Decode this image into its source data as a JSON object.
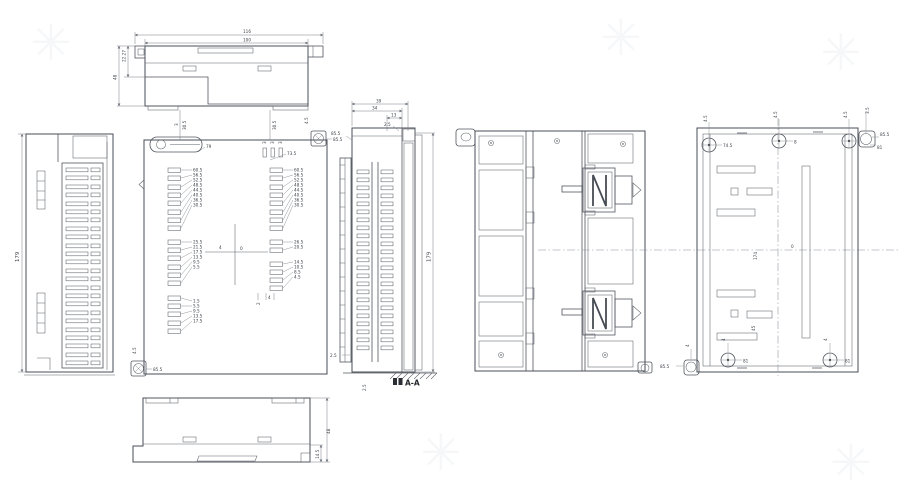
{
  "watermark": {
    "glyph": "✳"
  },
  "dims": {
    "top_view": {
      "outer_width": "116",
      "inner_width": "100",
      "step_depth": "22.27",
      "depth": "48"
    },
    "side_view": {
      "height": "179"
    },
    "front_view": {
      "t3a": "3",
      "t305a": "30.5",
      "din": "79",
      "t305b": "30.5",
      "t3b": "3",
      "t3c": "3",
      "t3d": "3",
      "slots3": "73.5",
      "pad_tr": "85.5",
      "pad_tr_v": "4.5",
      "ladder_left": [
        "60.5",
        "56.5",
        "52.5",
        "48.5",
        "44.5",
        "40.5",
        "36.5",
        "30.5",
        "25.5",
        "21.5",
        "17.5",
        "13.5",
        "9.5",
        "5.5",
        "1.5",
        "5.5",
        "9.5",
        "13.5",
        "17.5"
      ],
      "ladder_right": [
        "60.5",
        "56.5",
        "52.5",
        "48.5",
        "44.5",
        "40.5",
        "36.5",
        "30.5",
        "26.5",
        "20.5",
        "14.5",
        "10.5",
        "8.5",
        "4.5"
      ],
      "zero": "0",
      "tick4": "4",
      "b2": "2",
      "b4": "4",
      "pad_bl": "85.5",
      "pad_bl_v": "4.5"
    },
    "section_view": {
      "w39": "39",
      "w34": "34",
      "w13": "13",
      "t25": "2.5",
      "pad": "85.5",
      "height": "179",
      "b25a": "2.5",
      "b25b": "2.5",
      "label": "A-A"
    },
    "rear_view": {
      "hole_left": "74.5",
      "hole_mid": "8",
      "v1": "4.5",
      "v2": "4.5",
      "v3": "4.5",
      "v4": "3.5",
      "pad_tr_a": "85.5",
      "pad_tr_b": "81",
      "d174": "174",
      "zero": "0",
      "d45": "45",
      "pad_bl": "85.5",
      "pad_bl_v": "4",
      "bh1": "81",
      "bh2": "81",
      "bv1": "4",
      "bv2": "4"
    },
    "bottom_view": {
      "depth": "48",
      "step": "14.5"
    }
  }
}
